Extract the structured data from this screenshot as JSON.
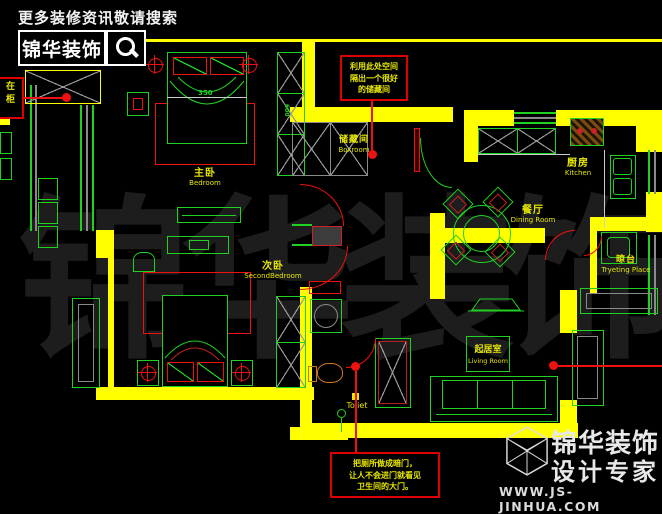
{
  "header": {
    "tagline": "更多装修资讯敬请搜索",
    "brand": "锦华装饰"
  },
  "watermark": "锦华装饰",
  "rooms": {
    "master_bedroom": {
      "zh": "主卧",
      "en": "Bedroom"
    },
    "second_bedroom": {
      "zh": "次卧",
      "en": "SecondBedroom"
    },
    "boxroom": {
      "zh": "储藏间",
      "en": "Boxroom"
    },
    "kitchen": {
      "zh": "厨房",
      "en": "Kitchen"
    },
    "dining_room": {
      "zh": "餐厅",
      "en": "Dining Room"
    },
    "living_room": {
      "zh": "起居室",
      "en": "Living Room"
    },
    "drying_place": {
      "zh": "晾台",
      "en": "Tryeting Place"
    },
    "toilet": {
      "en": "Toliet"
    }
  },
  "annotations": {
    "top_note": {
      "lines": [
        "利用此处空间",
        "隔出一个很好",
        "的储藏间"
      ]
    },
    "bottom_note": {
      "lines": [
        "把厕所做成暗门，",
        "让人不会进门就看见",
        "卫生间的大门。"
      ]
    },
    "left_note": {
      "lines": [
        "在",
        "柜"
      ]
    }
  },
  "dimensions": {
    "master_bed": "350",
    "wardrobe": "600"
  },
  "footer": {
    "brand": "锦华装饰",
    "subtitle": "设计专家",
    "website": "WWW.JS-JINHUA.COM"
  },
  "colors": {
    "wall": "#ffff00",
    "furniture": "#21d121",
    "accent": "#ee1111",
    "note_text": "#e8e800"
  }
}
